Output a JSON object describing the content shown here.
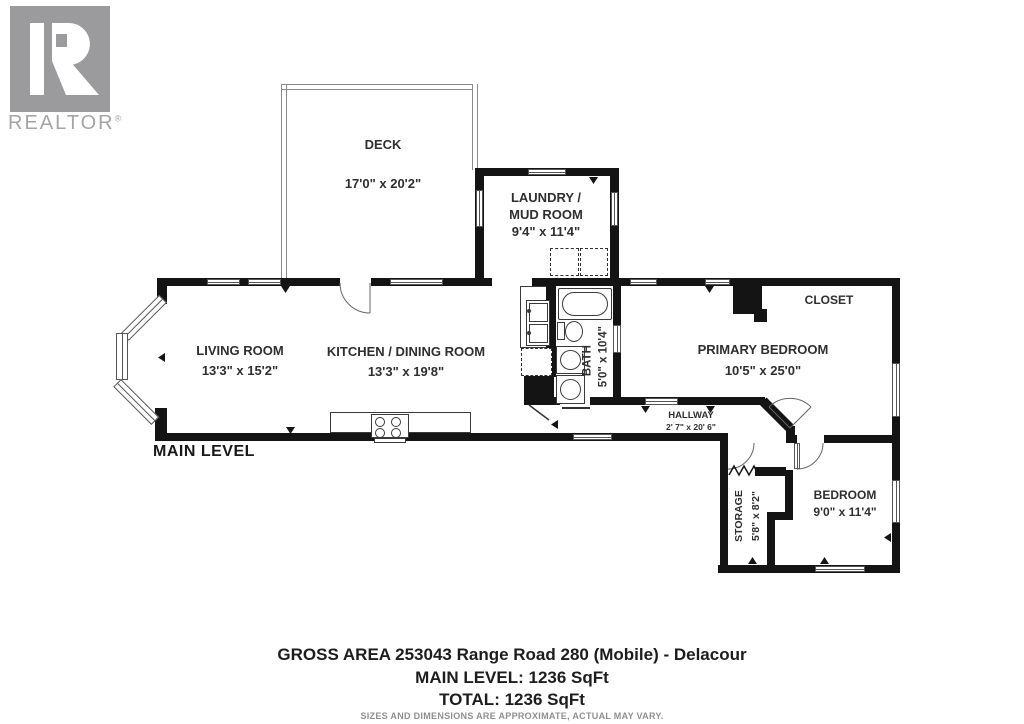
{
  "branding": {
    "realtor_text": "REALTOR",
    "registered": "®",
    "logo_letter": "R"
  },
  "level": {
    "label": "MAIN LEVEL"
  },
  "rooms": {
    "deck": {
      "name": "DECK",
      "dims": "17'0\" x 20'2\""
    },
    "laundry": {
      "name_line1": "LAUNDRY /",
      "name_line2": "MUD ROOM",
      "dims": "9'4\" x 11'4\""
    },
    "living": {
      "name": "LIVING ROOM",
      "dims": "13'3\" x 15'2\""
    },
    "kitchen": {
      "name": "KITCHEN / DINING ROOM",
      "dims": "13'3\" x 19'8\""
    },
    "bath": {
      "name": "BATH",
      "dims": "5'0\" x 10'4\""
    },
    "primary_bedroom": {
      "name": "PRIMARY BEDROOM",
      "dims": "10'5\" x 25'0\""
    },
    "closet": {
      "name": "CLOSET"
    },
    "hallway": {
      "name": "HALLWAY",
      "dims": "2' 7\" x 20' 6\""
    },
    "storage": {
      "name": "STORAGE",
      "dims": "5'8\" x 8'2\""
    },
    "bedroom": {
      "name": "BEDROOM",
      "dims": "9'0\" x 11'4\""
    }
  },
  "footer": {
    "address_line": "GROSS AREA 253043 Range Road 280 (Mobile) - Delacour",
    "main_level_area": "MAIN LEVEL: 1236 SqFt",
    "total_area": "TOTAL: 1236 SqFt",
    "disclaimer": "SIZES AND DIMENSIONS ARE APPROXIMATE, ACTUAL MAY VARY."
  },
  "colors": {
    "wall": "#141414",
    "logo_gray": "#9b9b9d",
    "fixture_line": "#3a3a3a",
    "deck_line": "#8a8a8a",
    "label_text": "#2f2f2f",
    "disclaimer_text": "#8f8f8f"
  }
}
